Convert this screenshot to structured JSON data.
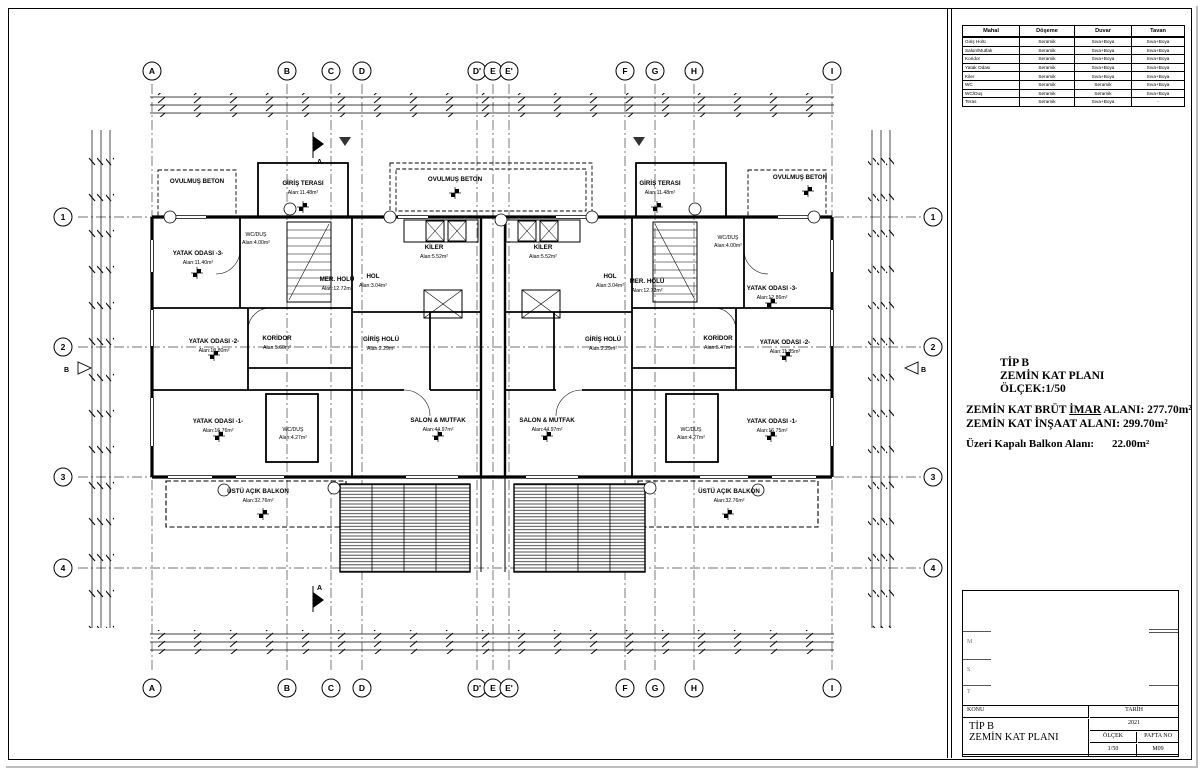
{
  "finishes_table": {
    "headers": [
      "Mahal",
      "Döşeme",
      "Duvar",
      "Tavan"
    ],
    "rows": [
      [
        "Giriş Holü",
        "Seramik",
        "Sıva+Boya",
        "Sıva+Boya"
      ],
      [
        "Salon/Mutfak",
        "Seramik",
        "Sıva+Boya",
        "Sıva+Boya"
      ],
      [
        "Koridor",
        "Seramik",
        "Sıva+Boya",
        "Sıva+Boya"
      ],
      [
        "Yatak Odası",
        "Seramik",
        "Sıva+Boya",
        "Sıva+Boya"
      ],
      [
        "Kiler",
        "Seramik",
        "Sıva+Boya",
        "Sıva+Boya"
      ],
      [
        "WC",
        "Seramik",
        "Seramik",
        "Sıva+Boya"
      ],
      [
        "WC/Duş",
        "Seramik",
        "Seramik",
        "Sıva+Boya"
      ],
      [
        "Teras",
        "Seramik",
        "Sıva+Boya",
        "-"
      ]
    ]
  },
  "plan_info": {
    "title1": "TİP B",
    "title2": "ZEMİN KAT PLANI",
    "title3": "ÖLÇEK:1/50",
    "brut_prefix": "ZEMİN KAT BRÜT ",
    "brut_bold": "İMAR",
    "brut_suffix": " ALANI: 277.70m²",
    "insaat": "ZEMİN KAT İNŞAAT ALANI: 299.70m²",
    "balkon_label": "Üzeri Kapalı Balkon Alanı:",
    "balkon_value": "22.00m²"
  },
  "title_block": {
    "konu_label": "KONU",
    "tarih_label": "TARİH",
    "tarih_value": "2021",
    "project_line1": "TİP B",
    "project_line2": "ZEMİN KAT PLANI",
    "olcek_label": "ÖLÇEK",
    "olcek_value": "1/50",
    "pafta_label": "PAFTA NO",
    "pafta_value": "M09"
  },
  "stamp_letters": [
    "M",
    "S",
    "T"
  ],
  "grid": {
    "cols": [
      "A",
      "B",
      "C",
      "D",
      "D'",
      "E",
      "E'",
      "F",
      "G",
      "H",
      "I"
    ],
    "rows": [
      "1",
      "2",
      "3",
      "4"
    ]
  },
  "sections": {
    "a": "A",
    "b": "B"
  },
  "rooms": [
    {
      "label": "OVULMUŞ BETON",
      "area": ""
    },
    {
      "label": "GİRİŞ TERASI",
      "area": "Alan:11.48m²"
    },
    {
      "label": "OVULMUŞ BETON",
      "area": ""
    },
    {
      "label": "GİRİŞ TERASI",
      "area": "Alan:11.48m²"
    },
    {
      "label": "OVULMUŞ BETON",
      "area": ""
    },
    {
      "label": "YATAK ODASI -3-",
      "area": "Alan:11.40m²"
    },
    {
      "label": "WC/DUŞ",
      "area": "Alan:4.00m²"
    },
    {
      "label": "WC/DUŞ",
      "area": "Alan:4.00m²"
    },
    {
      "label": "KİLER",
      "area": "Alan:5.52m²"
    },
    {
      "label": "KİLER",
      "area": "Alan:5.52m²"
    },
    {
      "label": "MER. HOLÜ",
      "area": "Alan:12.72m²"
    },
    {
      "label": "HOL",
      "area": "Alan:3.04m²"
    },
    {
      "label": "HOL",
      "area": "Alan:3.04m²"
    },
    {
      "label": "MER. HOLÜ",
      "area": "Alan:12.72m²"
    },
    {
      "label": "YATAK ODASI -3-",
      "area": "Alan:12.86m²"
    },
    {
      "label": "YATAK ODASI -2-",
      "area": "Alan:10.80m²"
    },
    {
      "label": "KORİDOR",
      "area": "Alan:5.60m²"
    },
    {
      "label": "GİRİŞ HOLÜ",
      "area": "Alan:2.29m²"
    },
    {
      "label": "GİRİŞ HOLÜ",
      "area": "Alan:2.29m²"
    },
    {
      "label": "KORİDOR",
      "area": "Alan:5.47m²"
    },
    {
      "label": "YATAK ODASI -2-",
      "area": "Alan:11.85m²"
    },
    {
      "label": "YATAK ODASI -1-",
      "area": "Alan:16.76m²"
    },
    {
      "label": "WC/DUŞ",
      "area": "Alan:4.27m²"
    },
    {
      "label": "SALON & MUTFAK",
      "area": "Alan:44.97m²"
    },
    {
      "label": "SALON & MUTFAK",
      "area": "Alan:44.97m²"
    },
    {
      "label": "WC/DUŞ",
      "area": "Alan:4.27m²"
    },
    {
      "label": "YATAK ODASI -1-",
      "area": "Alan:16.75m²"
    },
    {
      "label": "ÜSTÜ AÇIK BALKON",
      "area": "Alan:32.76m²"
    },
    {
      "label": "ÜSTÜ AÇIK BALKON",
      "area": "Alan:32.76m²"
    }
  ]
}
